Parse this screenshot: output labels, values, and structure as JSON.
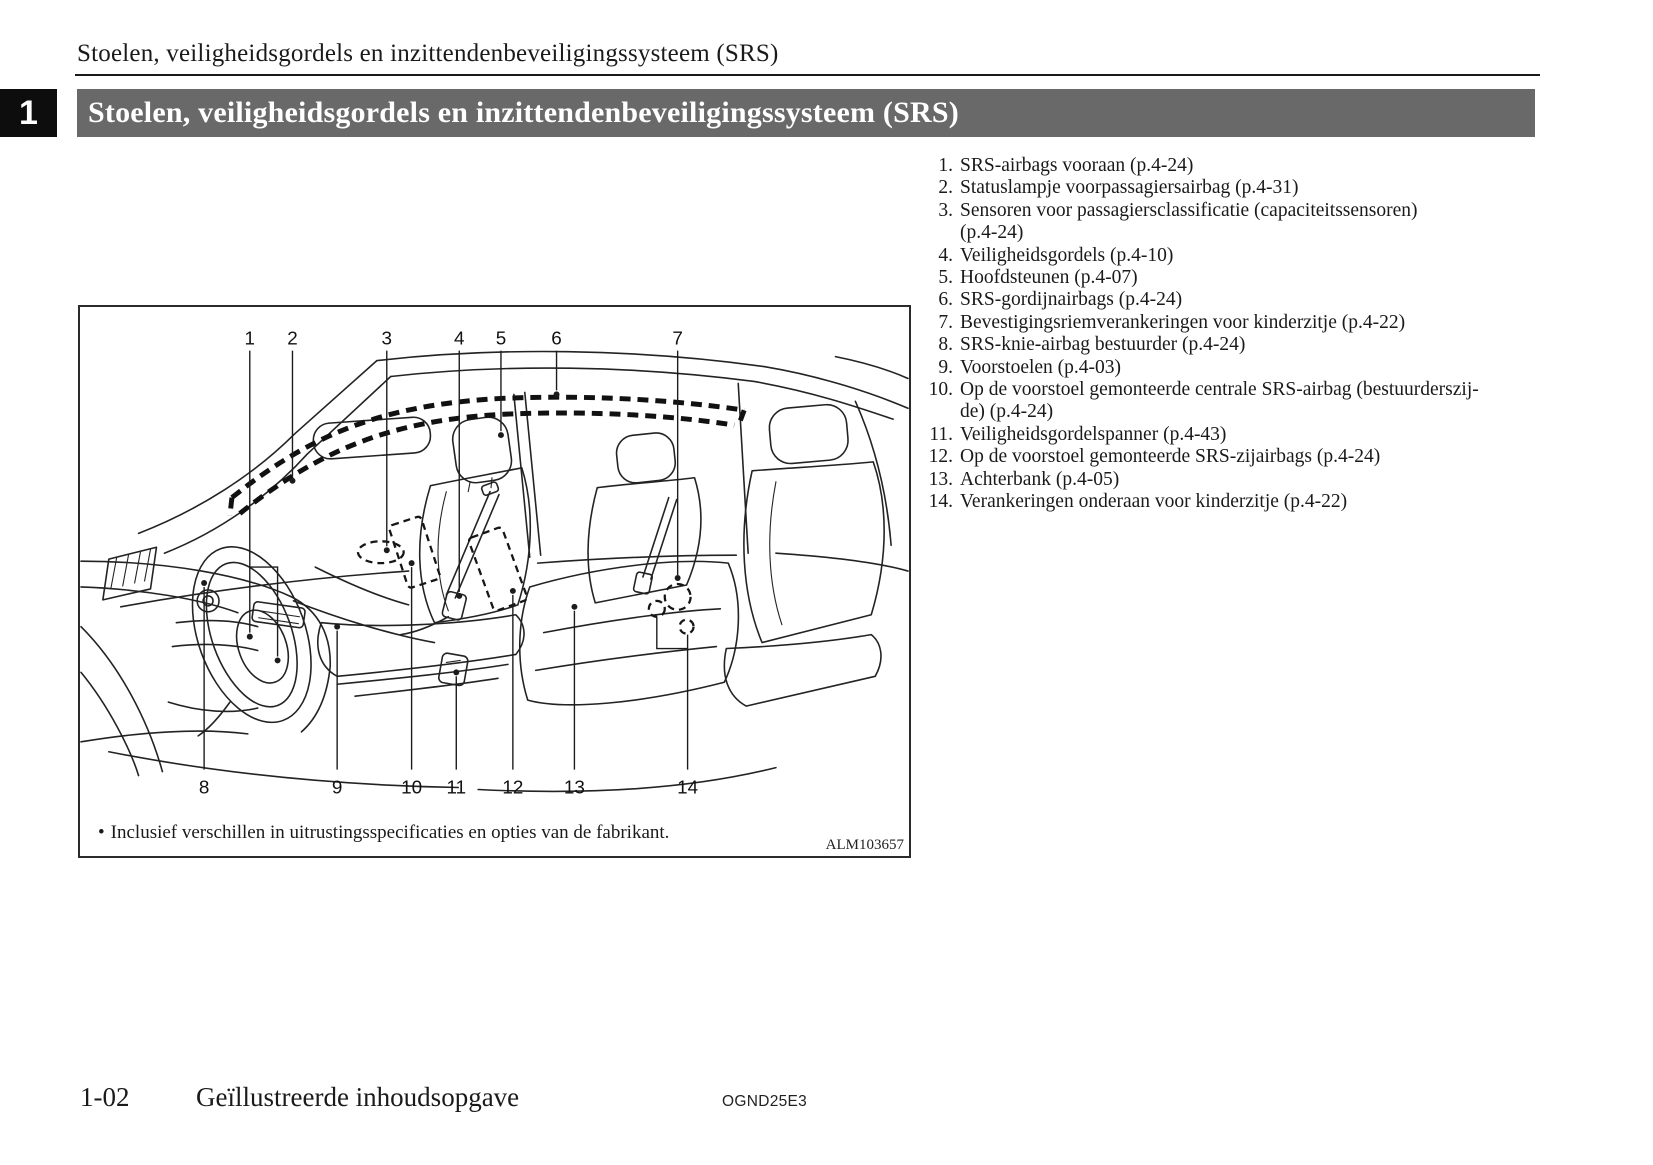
{
  "page": {
    "running_header": "Stoelen, veiligheidsgordels en inzittendenbeveiligingssysteem (SRS)",
    "chapter": {
      "number": "1",
      "title": "Stoelen, veiligheidsgordels en inzittendenbeveiligingssysteem (SRS)"
    },
    "colors": {
      "banner_bg": "#696969",
      "chapter_tab_bg": "#0d0d0d",
      "text": "#1a1a1a"
    },
    "footer": {
      "page_number": "1-02",
      "section_title": "Geïllustreerde inhoudsopgave",
      "doc_code": "OGND25E3"
    }
  },
  "figure": {
    "callouts": [
      "1",
      "2",
      "3",
      "4",
      "5",
      "6",
      "7",
      "8",
      "9",
      "10",
      "11",
      "12",
      "13",
      "14"
    ],
    "caption_bullet": "•",
    "caption": "Inclusief verschillen in uitrustingsspecificaties en opties van de fabrikant.",
    "image_code": "ALM103657"
  },
  "legend": {
    "items": [
      {
        "num": "1.",
        "lines": [
          "SRS-airbags vooraan (p.4-24)"
        ]
      },
      {
        "num": "2.",
        "lines": [
          "Statuslampje voorpassagiersairbag (p.4-31)"
        ]
      },
      {
        "num": "3.",
        "lines": [
          "Sensoren voor passagiersclassificatie (capaciteitssensoren)",
          "(p.4-24)"
        ]
      },
      {
        "num": "4.",
        "lines": [
          "Veiligheidsgordels (p.4-10)"
        ]
      },
      {
        "num": "5.",
        "lines": [
          "Hoofdsteunen (p.4-07)"
        ]
      },
      {
        "num": "6.",
        "lines": [
          "SRS-gordijnairbags (p.4-24)"
        ]
      },
      {
        "num": "7.",
        "lines": [
          "Bevestigingsriemverankeringen voor kinderzitje (p.4-22)"
        ]
      },
      {
        "num": "8.",
        "lines": [
          "SRS-knie-airbag bestuurder (p.4-24)"
        ]
      },
      {
        "num": "9.",
        "lines": [
          "Voorstoelen (p.4-03)"
        ]
      },
      {
        "num": "10.",
        "lines": [
          "Op de voorstoel gemonteerde centrale SRS-airbag (bestuurderszij-",
          "de) (p.4-24)"
        ]
      },
      {
        "num": "11.",
        "lines": [
          "Veiligheidsgordelspanner (p.4-43)"
        ]
      },
      {
        "num": "12.",
        "lines": [
          "Op de voorstoel gemonteerde SRS-zijairbags (p.4-24)"
        ]
      },
      {
        "num": "13.",
        "lines": [
          "Achterbank (p.4-05)"
        ]
      },
      {
        "num": "14.",
        "lines": [
          "Verankeringen onderaan voor kinderzitje (p.4-22)"
        ]
      }
    ]
  }
}
